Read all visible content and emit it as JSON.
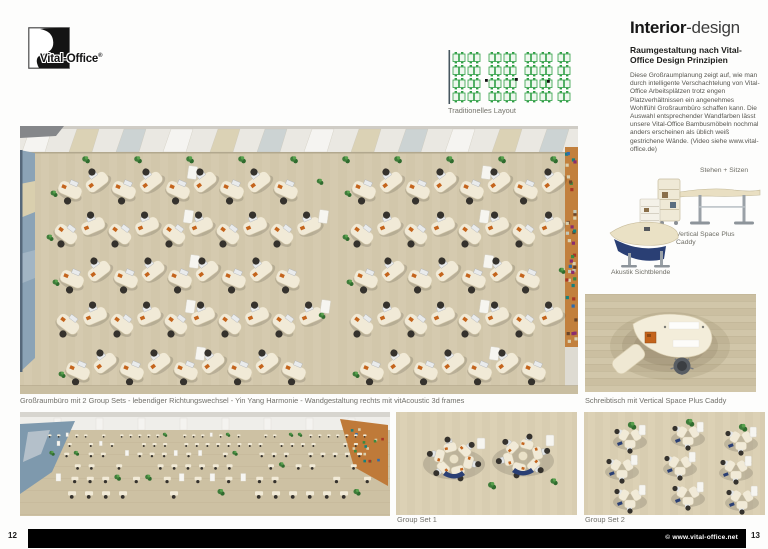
{
  "page": {
    "left_page_number": "12",
    "right_page_number": "13",
    "footer_copyright": "© www.vital-office.net"
  },
  "logo": {
    "text": "Vital-Office",
    "registered": "®"
  },
  "diagram": {
    "label": "Traditionelles Layout"
  },
  "article": {
    "title_bold": "Interior",
    "title_light": "-design",
    "subtitle": "Raumgestaltung nach Vital-Office Design Prinzipien",
    "body": "Diese Großraumplanung zeigt auf, wie man durch intelligente Verschachtelung von Vital-Office Arbeitsplätzen trotz engen Platzverhältnissen ein angenehmes Wohlfühl Großraumbüro schaffen kann. Die Auswahl entsprechender Wandfarben lässt unsere Vital-Office Bambusmöbeln nochmal anders erscheinen als üblich weiß gestrichene Wände. (Video siehe www.vital-office.de)"
  },
  "products": {
    "standing_desk_label": "Stehen + Sitzen",
    "caddy_label": "Vertical Space Plus Caddy",
    "screen_label": "Akustik Sichtblende"
  },
  "captions": {
    "main": "Großraumbüro mit 2 Group Sets - lebendiger Richtungswechsel - Yin Yang Harmonie - Wandgestaltung rechts mit vitAcoustic 3d frames",
    "desk_top": "Schreibtisch mit Vertical Space Plus Caddy",
    "group_set_1": "Group Set 1",
    "group_set_2": "Group Set 2"
  },
  "colors": {
    "floor": "#d2c7ab",
    "desk": "#f1ead7",
    "chair": "#35322d",
    "wall_blue": "#8ba3b6",
    "wall_orange": "#c2803d",
    "plant": "#3e7c3a",
    "diagram_green": "#2e9e44",
    "accent_orange": "#c4641c",
    "accent_navy": "#2a3f74"
  }
}
